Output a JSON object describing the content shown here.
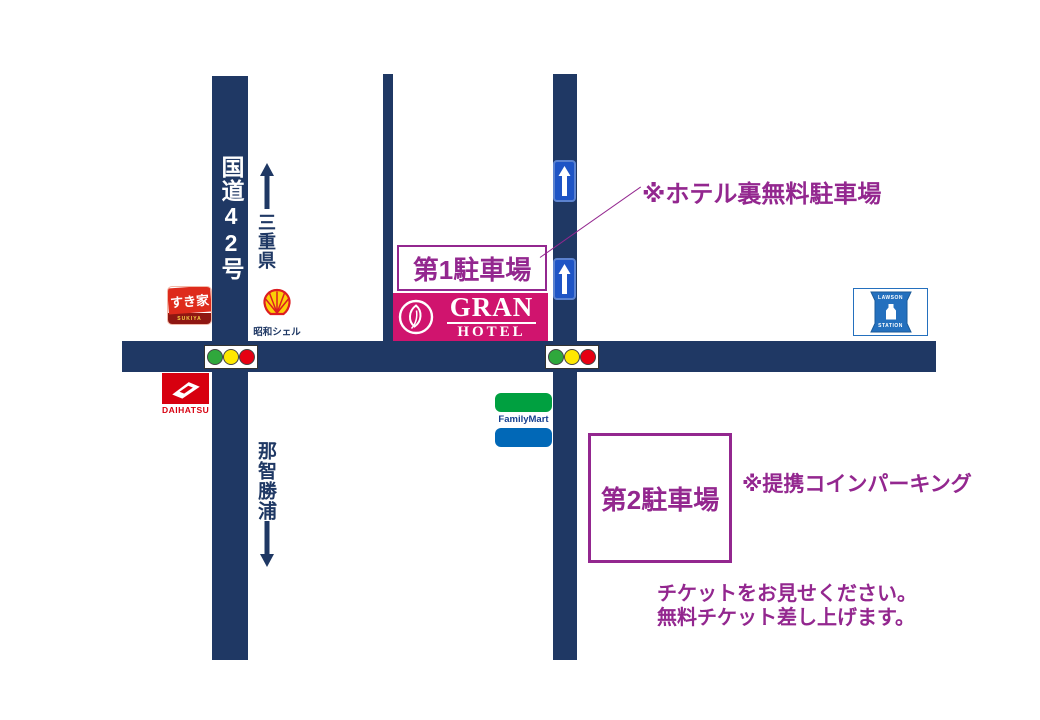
{
  "roads": {
    "route42_label": "国道42号",
    "north_destination": "三重県",
    "south_destination": "那智勝浦"
  },
  "parking1": {
    "label": "第1駐車場"
  },
  "parking2": {
    "label": "第2駐車場"
  },
  "hotel": {
    "name": "GRAN",
    "subname": "HOTEL"
  },
  "notes": {
    "back_parking": "※ホテル裏無料駐車場",
    "coin_parking": "※提携コインパーキング",
    "ticket_line1": "チケットをお見せください。",
    "ticket_line2": "無料チケット差し上げます。"
  },
  "landmarks": {
    "sukiya": {
      "name": "すき家",
      "romaji": "SUKIYA"
    },
    "shell": {
      "name": "昭和シェル"
    },
    "lawson": {
      "top": "LAWSON",
      "bottom": "STATION"
    },
    "daihatsu": {
      "name": "DAIHATSU"
    },
    "familymart": {
      "name": "FamilyMart"
    }
  },
  "colors": {
    "road_navy": "#1F3864",
    "accent_purple": "#93278F",
    "hotel_pink": "#D0146E",
    "oneway_sign_blue": "#1E54C5",
    "lawson_blue": "#2470BE",
    "familymart_green": "#00A040",
    "familymart_blue": "#0168B7",
    "sukiya_red": "#DE2B1C",
    "daihatsu_red": "#D7000F",
    "traffic_green": "#2FA83C",
    "traffic_yellow": "#FFE800",
    "traffic_red": "#E60012"
  }
}
